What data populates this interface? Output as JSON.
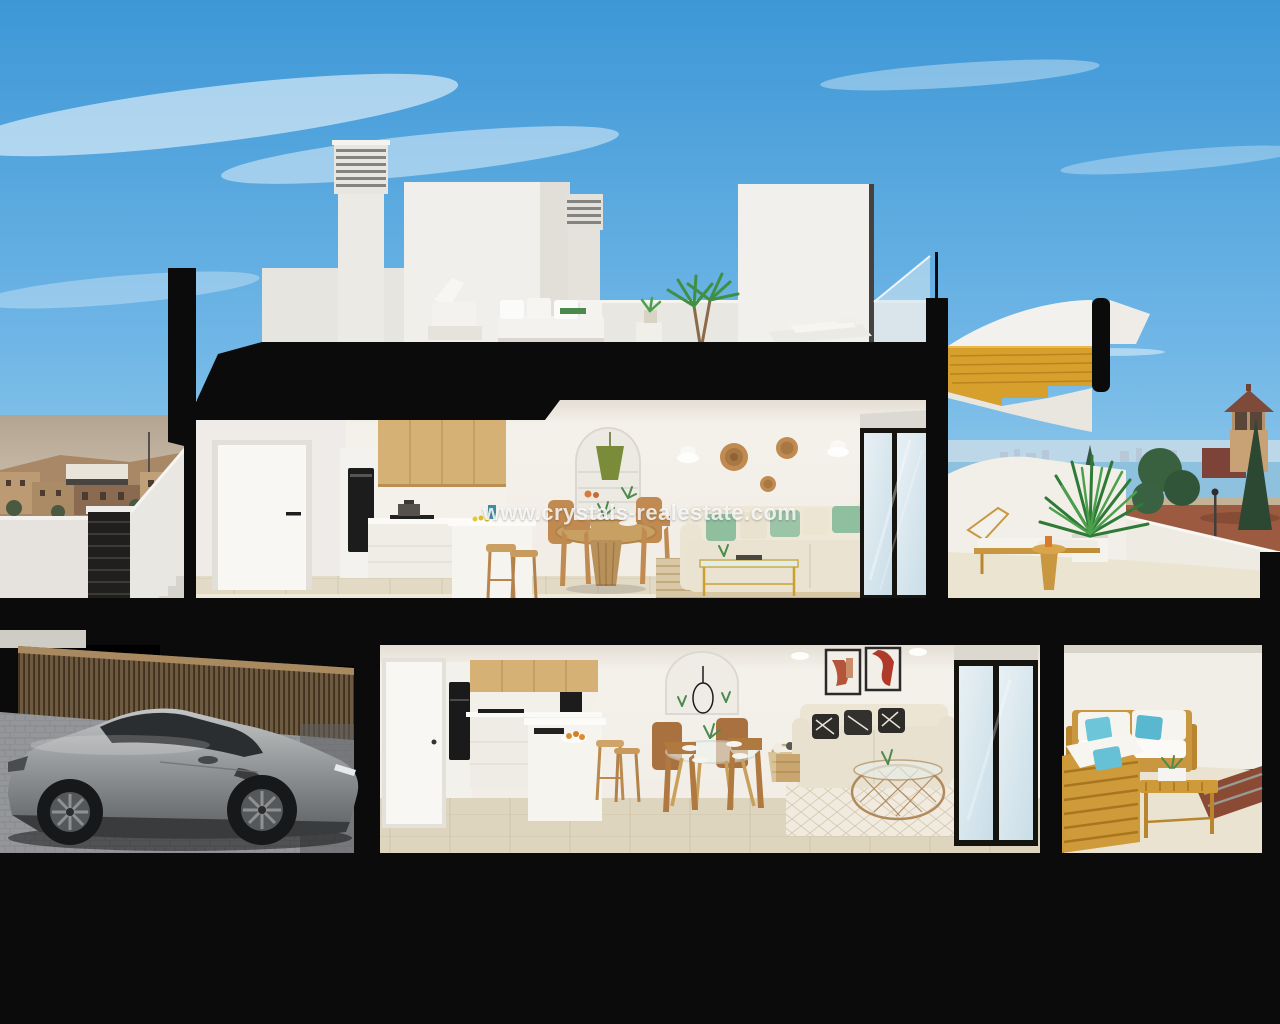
{
  "watermark": {
    "text": "www.crystals-realestate.com"
  },
  "scene": {
    "type": "3d-architectural-cross-section-render",
    "subject": "two-story coastal townhouse cutaway with roof terrace, garage with sports car, sea view",
    "palette": {
      "sky_top": "#3d97d6",
      "sky_bottom": "#a2d3ee",
      "section_cut_black": "#0b0b0b",
      "wall_white": "#f3f0ea",
      "floor_tile": "#ded5bf",
      "wood_cabinet": "#d5b175",
      "stair_wood": "#d79f2c",
      "outdoor_wood": "#c9973f",
      "rattan": "#c08a50",
      "sofa_cream": "#e9e1cf",
      "pillow_green": "#8fbf9f",
      "pillow_teal": "#6cc5d9",
      "sea": "#8ec1dd",
      "field_red": "#9c5a40",
      "car_silver": "#9fa1a3",
      "fence_wood": "#6e5a40",
      "pavement_grey": "#94969a"
    }
  }
}
